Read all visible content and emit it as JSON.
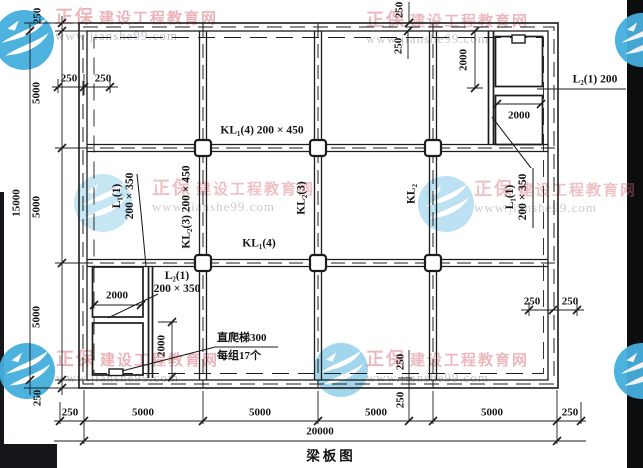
{
  "drawing": {
    "caption": "梁板图",
    "ink_color": "#1c1c1c",
    "paper_color": "#ffffff"
  },
  "watermark": {
    "brand": "正保",
    "site_name": "建设工程教育网",
    "url": "www.jianshe99.com",
    "logo_color": "#45aedd"
  },
  "labels": [
    {
      "n": "dim-left-250-top",
      "t": "250",
      "x": 38,
      "y": 16,
      "r": 1,
      "cls": "dim"
    },
    {
      "n": "dim-left-5000-1",
      "t": "5000",
      "x": 37,
      "y": 93,
      "r": 1,
      "cls": "dim"
    },
    {
      "n": "dim-left-5000-2",
      "t": "5000",
      "x": 37,
      "y": 207,
      "r": 1,
      "cls": "dim"
    },
    {
      "n": "dim-left-5000-3",
      "t": "5000",
      "x": 37,
      "y": 317,
      "r": 1,
      "cls": "dim"
    },
    {
      "n": "dim-left-250-bottom",
      "t": "250",
      "x": 38,
      "y": 398,
      "r": 1,
      "cls": "dim"
    },
    {
      "n": "dim-left-15000",
      "t": "15000",
      "x": 17,
      "y": 203,
      "r": 1,
      "cls": "dim"
    },
    {
      "n": "dim-bottom-250-left",
      "t": "250",
      "x": 70,
      "y": 413,
      "cls": "dim"
    },
    {
      "n": "dim-bottom-5000-1",
      "t": "5000",
      "x": 143,
      "y": 413,
      "cls": "dim"
    },
    {
      "n": "dim-bottom-5000-2",
      "t": "5000",
      "x": 260,
      "y": 413,
      "cls": "dim"
    },
    {
      "n": "dim-bottom-5000-3",
      "t": "5000",
      "x": 376,
      "y": 413,
      "cls": "dim"
    },
    {
      "n": "dim-bottom-5000-4",
      "t": "5000",
      "x": 492,
      "y": 413,
      "cls": "dim"
    },
    {
      "n": "dim-bottom-250-right",
      "t": "250",
      "x": 570,
      "y": 413,
      "cls": "dim"
    },
    {
      "n": "dim-bottom-20000",
      "t": "20000",
      "x": 320,
      "y": 432,
      "cls": "dim"
    },
    {
      "n": "dim-top-250-outer",
      "t": "250",
      "x": 400,
      "y": 10,
      "r": 1,
      "cls": "dim"
    },
    {
      "n": "dim-top-250-inner",
      "t": "250",
      "x": 399,
      "y": 46,
      "r": 1,
      "cls": "dim"
    },
    {
      "n": "dim-bottom-mid-250-upper",
      "t": "250",
      "x": 401,
      "y": 362,
      "r": 1,
      "cls": "dim"
    },
    {
      "n": "dim-bottom-mid-250-lower",
      "t": "250",
      "x": 401,
      "y": 400,
      "r": 1,
      "cls": "dim"
    },
    {
      "n": "dim-wall-250-tl-a",
      "t": "250",
      "x": 69,
      "y": 79,
      "cls": "dim"
    },
    {
      "n": "dim-wall-250-tl-b",
      "t": "250",
      "x": 103,
      "y": 79,
      "cls": "dim"
    },
    {
      "n": "dim-wall-250-br-a",
      "t": "250",
      "x": 532,
      "y": 302,
      "cls": "dim"
    },
    {
      "n": "dim-wall-250-br-b",
      "t": "250",
      "x": 570,
      "y": 302,
      "cls": "dim"
    },
    {
      "n": "dim-2000-shaft-vertical",
      "t": "2000",
      "x": 464,
      "y": 60,
      "r": 1,
      "cls": "dim"
    },
    {
      "n": "dim-2000-shaft-horizontal",
      "t": "2000",
      "x": 519,
      "y": 116,
      "cls": "dim"
    },
    {
      "n": "dim-2000-room-a",
      "t": "2000",
      "x": 117,
      "y": 296,
      "cls": "dim"
    },
    {
      "n": "dim-2000-room-b",
      "t": "2000",
      "x": 162,
      "y": 346,
      "r": 1,
      "cls": "dim"
    },
    {
      "n": "label-beam-kl1-top",
      "t": "KL₁(4) 200 × 450",
      "x": 262,
      "y": 131,
      "cls": "beam"
    },
    {
      "n": "label-beam-kl1-bottom",
      "t": "KL₁(4)",
      "x": 259,
      "y": 244,
      "cls": "beam"
    },
    {
      "n": "label-beam-kl2-left",
      "t": "KL₂(3) 200 × 450",
      "x": 187,
      "y": 207,
      "r": 1,
      "cls": "beam"
    },
    {
      "n": "label-beam-kl2-mid",
      "t": "KL₂(3)",
      "x": 302,
      "y": 198,
      "r": 1,
      "cls": "beam"
    },
    {
      "n": "label-beam-kl2-right",
      "t": "KL₂",
      "x": 412,
      "y": 194,
      "r": 1,
      "cls": "beam"
    },
    {
      "n": "label-beam-l1-left",
      "t": "L₁(1)\n200 × 350",
      "x": 124,
      "y": 196,
      "r": 1,
      "cls": "beam"
    },
    {
      "n": "label-beam-l1-right",
      "t": "L₁(1)\n200 × 350",
      "x": 517,
      "y": 197,
      "r": 1,
      "cls": "beam"
    },
    {
      "n": "label-beam-l2-mid",
      "t": "L₂(1)\n200 × 350",
      "x": 177,
      "y": 283,
      "cls": "beam"
    },
    {
      "n": "label-beam-l2-right",
      "t": "L₂(1) 200",
      "x": 595,
      "y": 80,
      "cls": "beam"
    },
    {
      "n": "note-ladder",
      "t": "直爬梯300\n每组17个",
      "x": 217,
      "y": 330,
      "a": "tl",
      "cls": "note"
    },
    {
      "n": "drawing-title",
      "t": "梁板图",
      "x": 331,
      "y": 456,
      "cls": "title"
    }
  ],
  "watermarks": [
    {
      "x": 55,
      "y": 8,
      "opacity": 0.9
    },
    {
      "x": 366,
      "y": 11,
      "opacity": 0.85
    },
    {
      "x": 152,
      "y": 179,
      "opacity": 0.75
    },
    {
      "x": 474,
      "y": 180,
      "opacity": 0.75
    },
    {
      "x": 56,
      "y": 350,
      "opacity": 0.9
    },
    {
      "x": 366,
      "y": 350,
      "opacity": 0.85
    }
  ],
  "logos": [
    {
      "cx": 24,
      "cy": 40,
      "r": 31,
      "opacity": 0.95
    },
    {
      "cx": 642,
      "cy": 40,
      "r": 28,
      "opacity": 0.95
    },
    {
      "cx": 103,
      "cy": 203,
      "r": 30,
      "opacity": 0.3
    },
    {
      "cx": 446,
      "cy": 204,
      "r": 29,
      "opacity": 0.36
    },
    {
      "cx": 27,
      "cy": 371,
      "r": 29,
      "opacity": 0.95
    },
    {
      "cx": 341,
      "cy": 370,
      "r": 28,
      "opacity": 0.5
    },
    {
      "cx": 642,
      "cy": 371,
      "r": 29,
      "opacity": 0.95
    }
  ]
}
